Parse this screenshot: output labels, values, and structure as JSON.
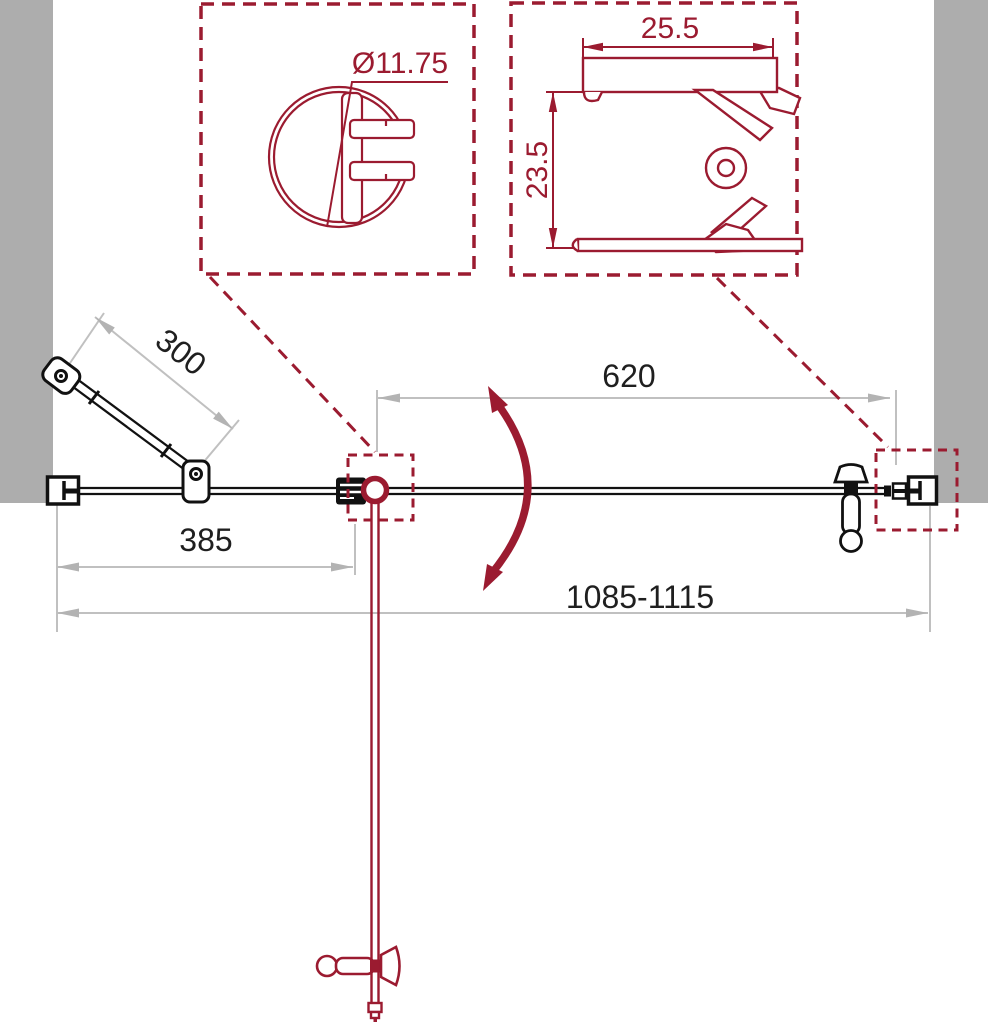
{
  "drawing": {
    "kind": "shower-door installation diagram, top view with profile details"
  },
  "colors": {
    "drawing_red": "#9b1b30",
    "wall_gray": "#adadad",
    "dimension_line_gray": "#c0c0c0",
    "dimension_arrow_gray": "#b3b3b3",
    "text_dark": "#1f1f1f"
  },
  "detail_round_profile": {
    "diameter": "Ø11.75"
  },
  "detail_wall_profile": {
    "width": "25.5",
    "height": "23.5"
  },
  "main_view": {
    "support_bar_length": "300",
    "fixed_panel_width": "385",
    "door_width": "620",
    "total_width_range": "1085-1115"
  }
}
